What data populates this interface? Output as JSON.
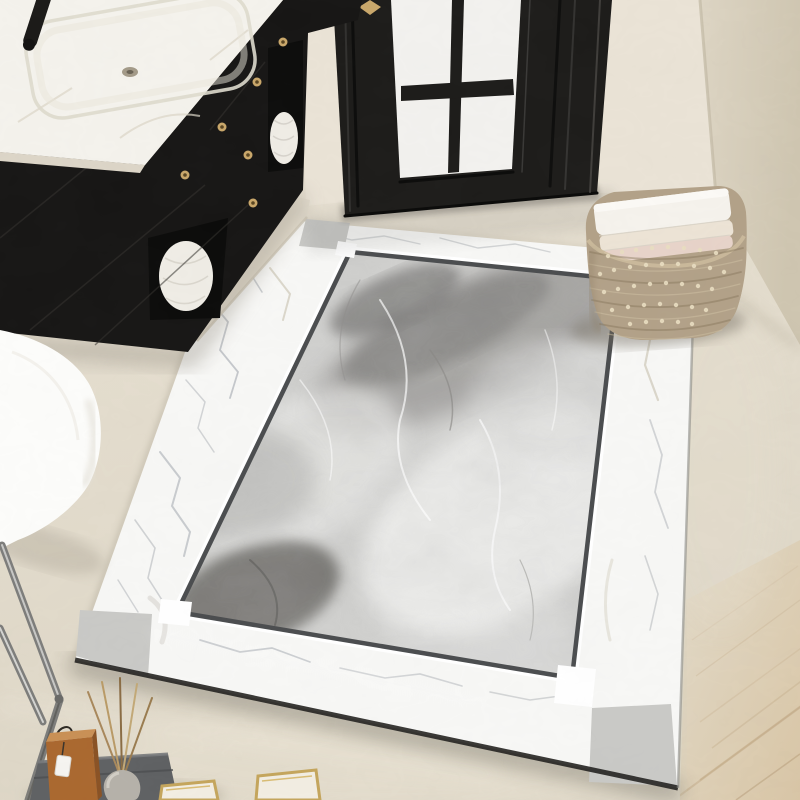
{
  "meta": {
    "description": "Product photo: marble-pattern area rug in a bathroom entry scene",
    "objects": [
      "marble-rug",
      "rug-border",
      "rug-center",
      "rug-corner-squares",
      "vanity-cabinet",
      "marble-countertop",
      "sink",
      "faucet",
      "black-door",
      "glass-panes",
      "woven-basket",
      "towel-stack",
      "toilet",
      "chrome-rack",
      "serving-tray",
      "wooden-box",
      "reed-diffuser",
      "gold-trinket-boxes",
      "wood-floor",
      "wall",
      "floor"
    ]
  },
  "palette": {
    "floor_top": "#e9e2d4",
    "floor_bottom": "#ded7c7",
    "floor_platform": "#e3dccd",
    "wall_left": "#eae3d6",
    "wall_right_near": "#ddd5c4",
    "wall_right_far": "#cfc6b1",
    "door_black": "#1d1c1a",
    "glass": "#f2f1ee",
    "gold": "#c9a76a",
    "counter_marble": "#f4f2ec",
    "counter_edge": "#dcd5c7",
    "cabinet_black": "#171615",
    "shelf_dark": "#0c0c0b",
    "towel_white": "#efece5",
    "rug_border": "#f7f7f5",
    "rug_vein": "#a9aeb4",
    "rug_vein_warm": "#c6bfae",
    "rug_corner_square": "#c9c9c6",
    "rug_frame": "#4b4d4f",
    "rug_halo": "#ffffff",
    "rug_center_base": "#d0d0ce",
    "rug_center_light": "#efefed",
    "rug_center_mid": "#9b9a98",
    "rug_center_dark": "#858482",
    "rug_center_deep": "#6f6e6b",
    "rug_edge_dark": "#232220",
    "wood_floor": "#d9c6a6",
    "wood_line": "#bfa781",
    "basket_base": "#b2a188",
    "basket_weave_dark": "#85755c",
    "basket_weave_light": "#cdbfa2",
    "basket_bead": "#e9ddc1",
    "stack_white": "#f5f2ec",
    "stack_cream": "#ece3d5",
    "stack_pink": "#e7d3c9",
    "toilet_white": "#fcfcfa",
    "chrome": "#7d7d7b",
    "chrome_light": "#cfcfcd",
    "tray": "#5f6163",
    "wood_box": "#aa682f",
    "wood_box_top": "#c99055",
    "tag_white": "#f5f4f0",
    "vase_grey": "#b5b1a9",
    "stick": "#a98a58",
    "gold_box_face": "#f2ede2",
    "shadow_soft": "#8d8574"
  }
}
